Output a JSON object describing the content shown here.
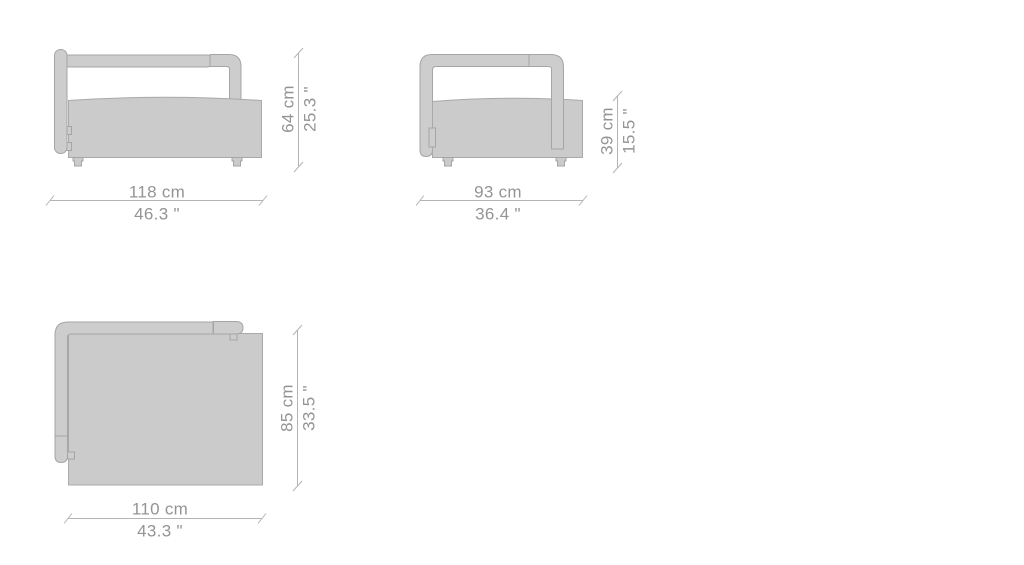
{
  "views": {
    "front": {
      "width_cm": "118 cm",
      "width_in": "46.3 \"",
      "height_cm": "64 cm",
      "height_in": "25.3 \""
    },
    "side": {
      "width_cm": "93 cm",
      "width_in": "36.4 \"",
      "height_cm": "39 cm",
      "height_in": "15.5 \""
    },
    "top": {
      "width_cm": "110 cm",
      "width_in": "43.3 \"",
      "height_cm": "85 cm",
      "height_in": "33.5 \""
    }
  },
  "colors": {
    "background": "#ffffff",
    "body_fill": "#cbcbcb",
    "body_stroke": "#a9a9a9",
    "tube_fill": "#cdcdcd",
    "tube_stroke": "#a5a5a5",
    "dim_line": "#b4b4b4",
    "dim_text": "#949494"
  }
}
